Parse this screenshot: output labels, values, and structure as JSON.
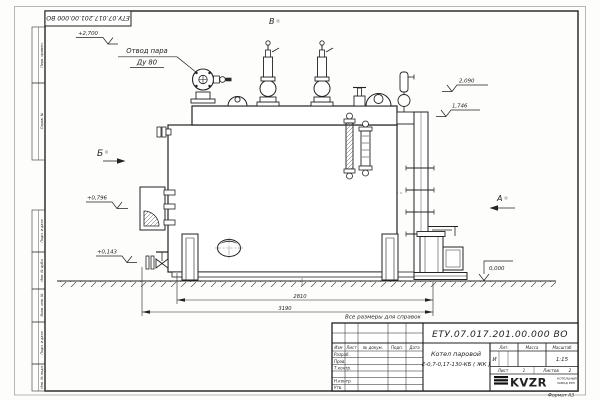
{
  "sheet": {
    "corner_stamp": "ЕТУ.07.017.201.00.000 ВО",
    "format_label": "Формат А3",
    "note": "Все размеры для справок",
    "margin_boxes": [
      "Перв. примен.",
      "Справ. №",
      "Подп. и дата",
      "Инв. № дубл.",
      "Взам. инв. №",
      "Подп. и дата",
      "Инв. № подл."
    ]
  },
  "drawing": {
    "label_steam_line1": "Отвод пара",
    "label_steam_line2": "Ду 80",
    "views": {
      "a": "А",
      "b": "Б",
      "v": "В"
    },
    "elevations": {
      "top": "+2,700",
      "drum": "2,090",
      "gauge": "1,746",
      "mid": "+0,796",
      "low": "+0,143",
      "zero": "0,000"
    },
    "dimensions": {
      "inner": "2810",
      "overall": "3190"
    }
  },
  "title_block": {
    "designation": "ЕТУ.07.017.201.00.000 ВО",
    "product_name": "Котел паровой",
    "product_type": "Е-0,7-0,17-130-КБ ( ЖК )",
    "cols": {
      "izm": "Изм",
      "list": "Лист",
      "doc": "№ докум.",
      "sign": "Подп.",
      "date": "Дата"
    },
    "rows": {
      "razrab": "Разраб.",
      "prov": "Пров.",
      "tkontr": "Т.контр.",
      "nkontr": "Н.контр.",
      "utv": "Утв."
    },
    "lit_label": "Лит.",
    "mass_label": "Масса",
    "scale_label": "Масштаб",
    "lit_value": "И",
    "scale_value": "1:15",
    "sheet_label": "Лист",
    "sheet_number": "1",
    "sheets_label": "Листов",
    "sheets_total": "2",
    "company_logo": "KVZR",
    "company_line1": "КОТЕЛЬНЫЙ",
    "company_line2": "ЗАВОД РЭП"
  }
}
